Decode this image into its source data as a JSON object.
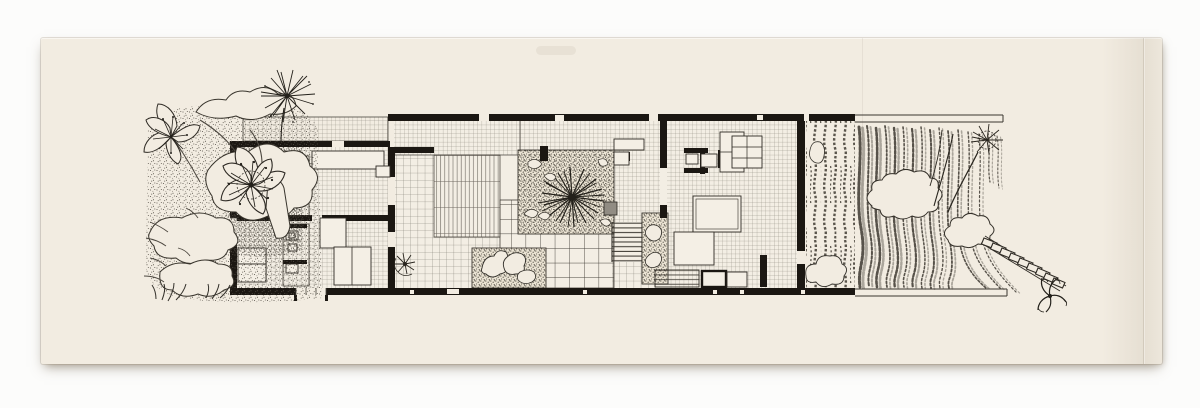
{
  "canvas": {
    "width": 1200,
    "height": 408
  },
  "colors": {
    "background": "#fcfcfb",
    "paper": "#f2ece1",
    "paper_edge": "#d9d1bf",
    "ink": "#1b1712",
    "line": "#4a463f",
    "grid": "#8e897e",
    "texture": "#57524a",
    "accent_gray": "#918c83",
    "shadow": "rgba(110,98,78,0.45)"
  },
  "drawing": {
    "type": "architectural-floor-plan-ink-drawing",
    "elements": [
      "left-garden-foliage",
      "blossom-flowers",
      "starburst-tree",
      "roof-terrace-grid",
      "bedroom-wing",
      "bath-pods",
      "patio-table",
      "central-courtyard",
      "courtyard-tree",
      "paver-grid",
      "tatami-mat-strips",
      "planted-beds",
      "stair-run",
      "planter-strip",
      "living-wing",
      "kitchen-fixtures",
      "bed-platforms",
      "closet-grid",
      "east-walled-garden",
      "terraced-garden-hatching",
      "tree-canopies",
      "stone-step-path",
      "plant-sprig"
    ]
  }
}
